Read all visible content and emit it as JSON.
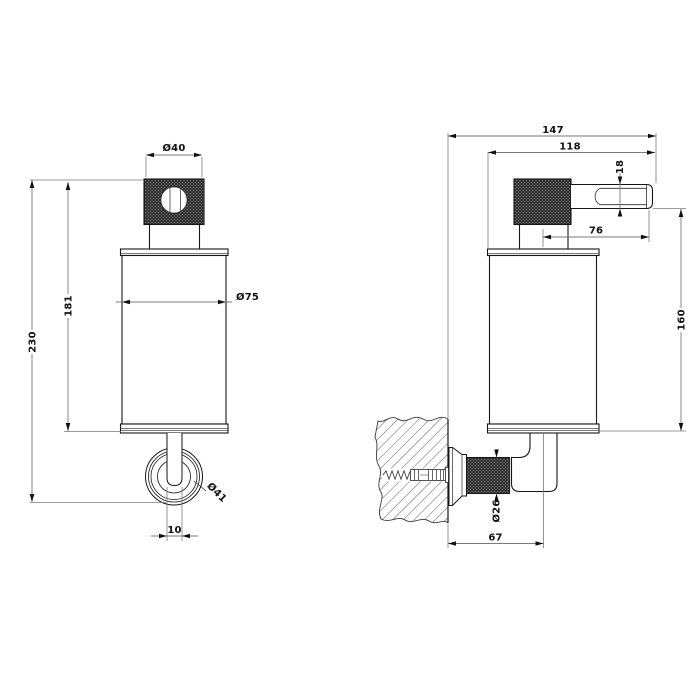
{
  "drawing": {
    "background": "#ffffff",
    "object_line_color": "#161616",
    "dimension_line_color": "#7a7a7a",
    "text_color": "#111111",
    "knurl_color": "#1e1e1e",
    "views": {
      "front": {
        "dims": {
          "cap_diameter": "Ø40",
          "body_diameter": "Ø75",
          "ring_diameter": "Ø41",
          "spout_width": "10",
          "body_height": "181",
          "total_height": "230"
        }
      },
      "side": {
        "dims": {
          "total_depth": "147",
          "body_depth": "118",
          "lever_reach": "76",
          "lever_height": "18",
          "height_below_lever": "160",
          "post_diameter": "Ø26",
          "wall_to_axis": "67"
        }
      }
    }
  }
}
